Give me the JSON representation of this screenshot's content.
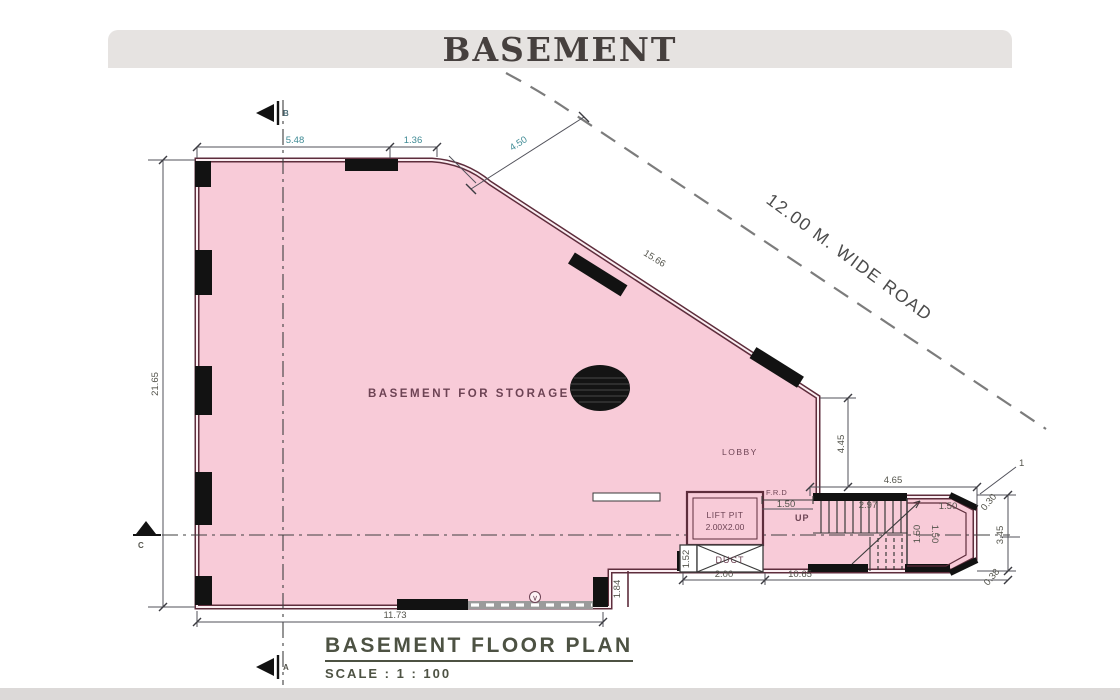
{
  "header": {
    "title": "BASEMENT"
  },
  "footer": {
    "plan_title": "BASEMENT  FLOOR PLAN",
    "scale_label": "SCALE :  1 : 100"
  },
  "road": {
    "label": "12.00 M. WIDE ROAD"
  },
  "room": {
    "label": "BASEMENT FOR STORAGE"
  },
  "areas": {
    "lobby": "LOBBY",
    "lift_pit_1": "LIFT PIT",
    "lift_pit_2": "2.00X2.00",
    "duct": "DUCT",
    "up": "UP",
    "frd": "F.R.D",
    "vent_symbol": "∨"
  },
  "markers": {
    "top": "B",
    "bottom": "A",
    "left": "C",
    "grid": "1"
  },
  "dims": {
    "top_left": "5.48",
    "top_right": "1.36",
    "road_offset": "4.50",
    "diagonal_wall": "15.66",
    "left_height": "21.65",
    "bottom_width": "11.73",
    "step_height": "1.84",
    "right_wall_drop": "4.45",
    "stair_top_width": "4.65",
    "door_width": "1.50",
    "stair_run": "2.97",
    "landing_width": "1.50",
    "flight_width_a": "1.50",
    "flight_width_b": "1.50",
    "duct_width": "2.00",
    "corridor_width": "10.65",
    "stair_block_height": "3.45",
    "corner_top": "0.30",
    "corner_bottom": "0.38",
    "duct_side": "1.52"
  },
  "colors": {
    "floor_fill": "#f8cbd8",
    "wall": "#5e2d3c",
    "dim_teal": "#3f8a94",
    "dim_gray": "#54544c",
    "band": "#e6e3e1"
  }
}
